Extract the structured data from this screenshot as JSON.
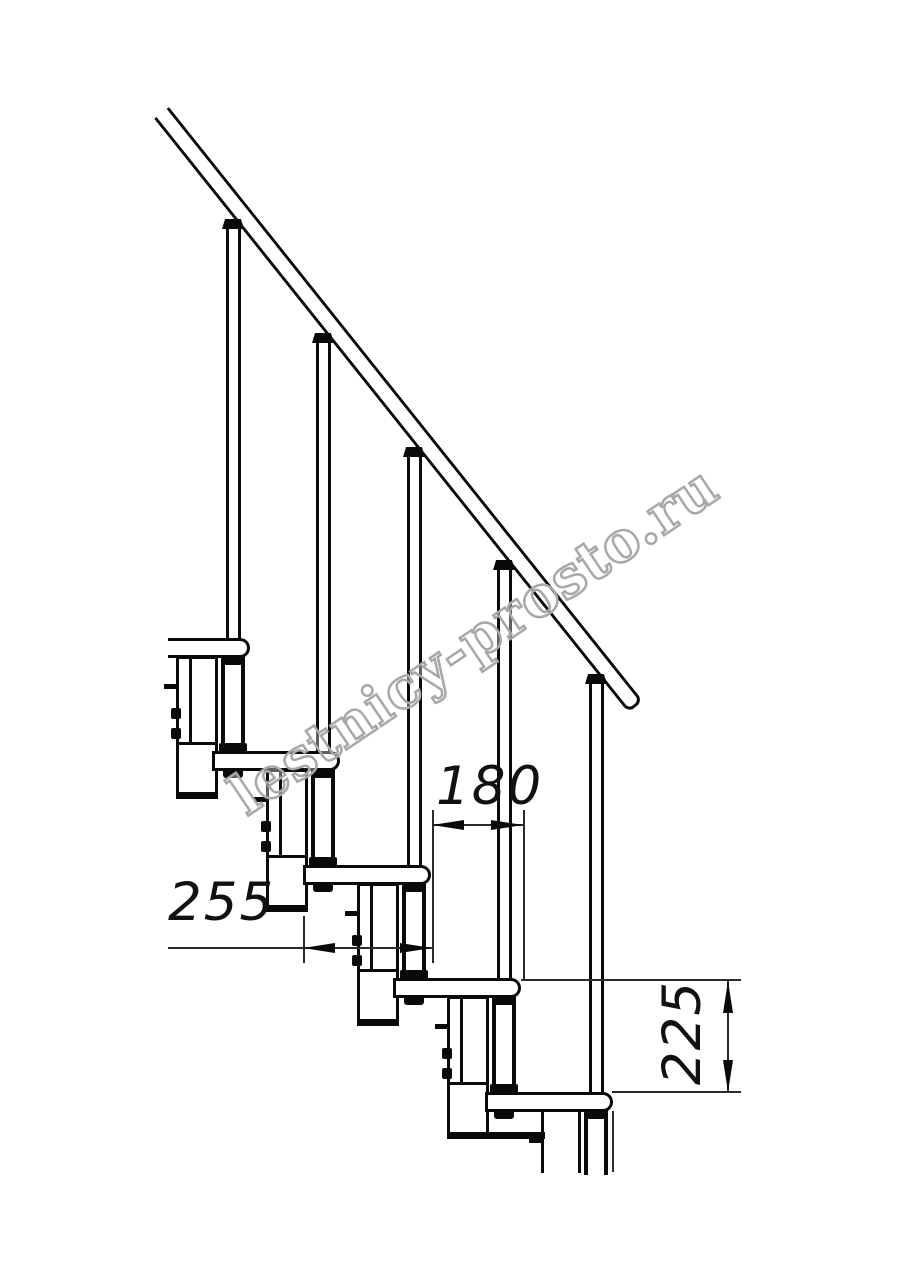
{
  "title": "Modular staircase side-view technical drawing",
  "watermark": {
    "text": "lestnicy-prosto.ru",
    "color": "#a8a8a8",
    "angle_deg": -34
  },
  "dimensions": {
    "tread_depth": {
      "label": "255"
    },
    "going": {
      "label": "180"
    },
    "rise": {
      "label": "225"
    }
  },
  "colors": {
    "background": "#ffffff",
    "line": "#0a0a0a",
    "thin_line": "#2b2b2b"
  },
  "drawing": {
    "noses": [
      250,
      340,
      431,
      521,
      613
    ],
    "tread_tops": [
      638,
      751,
      865,
      978,
      1092
    ],
    "tread_height": 20,
    "tread_depth_px": 128,
    "left_crop_x": 168,
    "bottom_cut_y": 1173,
    "rail": {
      "x": 169,
      "y": 107,
      "length": 760,
      "thickness": 19,
      "angle_deg": 51.4
    },
    "baluster_top_y": [
      219,
      333,
      447,
      560,
      674
    ],
    "dims": {
      "lines": [
        [
          168,
          947,
          432,
          947
        ],
        [
          432,
          824,
          523,
          824
        ],
        [
          727,
          980,
          727,
          1092
        ]
      ],
      "ext": [
        [
          432,
          810,
          432,
          963
        ],
        [
          523,
          810,
          523,
          980
        ],
        [
          303,
          916,
          303,
          963
        ],
        [
          521,
          979,
          741,
          979
        ],
        [
          612,
          1091,
          741,
          1091
        ],
        [
          612,
          1111,
          612,
          1172
        ]
      ],
      "arrows": [
        [
          303,
          948,
          "L"
        ],
        [
          432,
          948,
          "R"
        ],
        [
          432,
          825,
          "L"
        ],
        [
          523,
          825,
          "R"
        ],
        [
          728,
          981,
          "U"
        ],
        [
          728,
          1092,
          "D"
        ]
      ]
    }
  }
}
